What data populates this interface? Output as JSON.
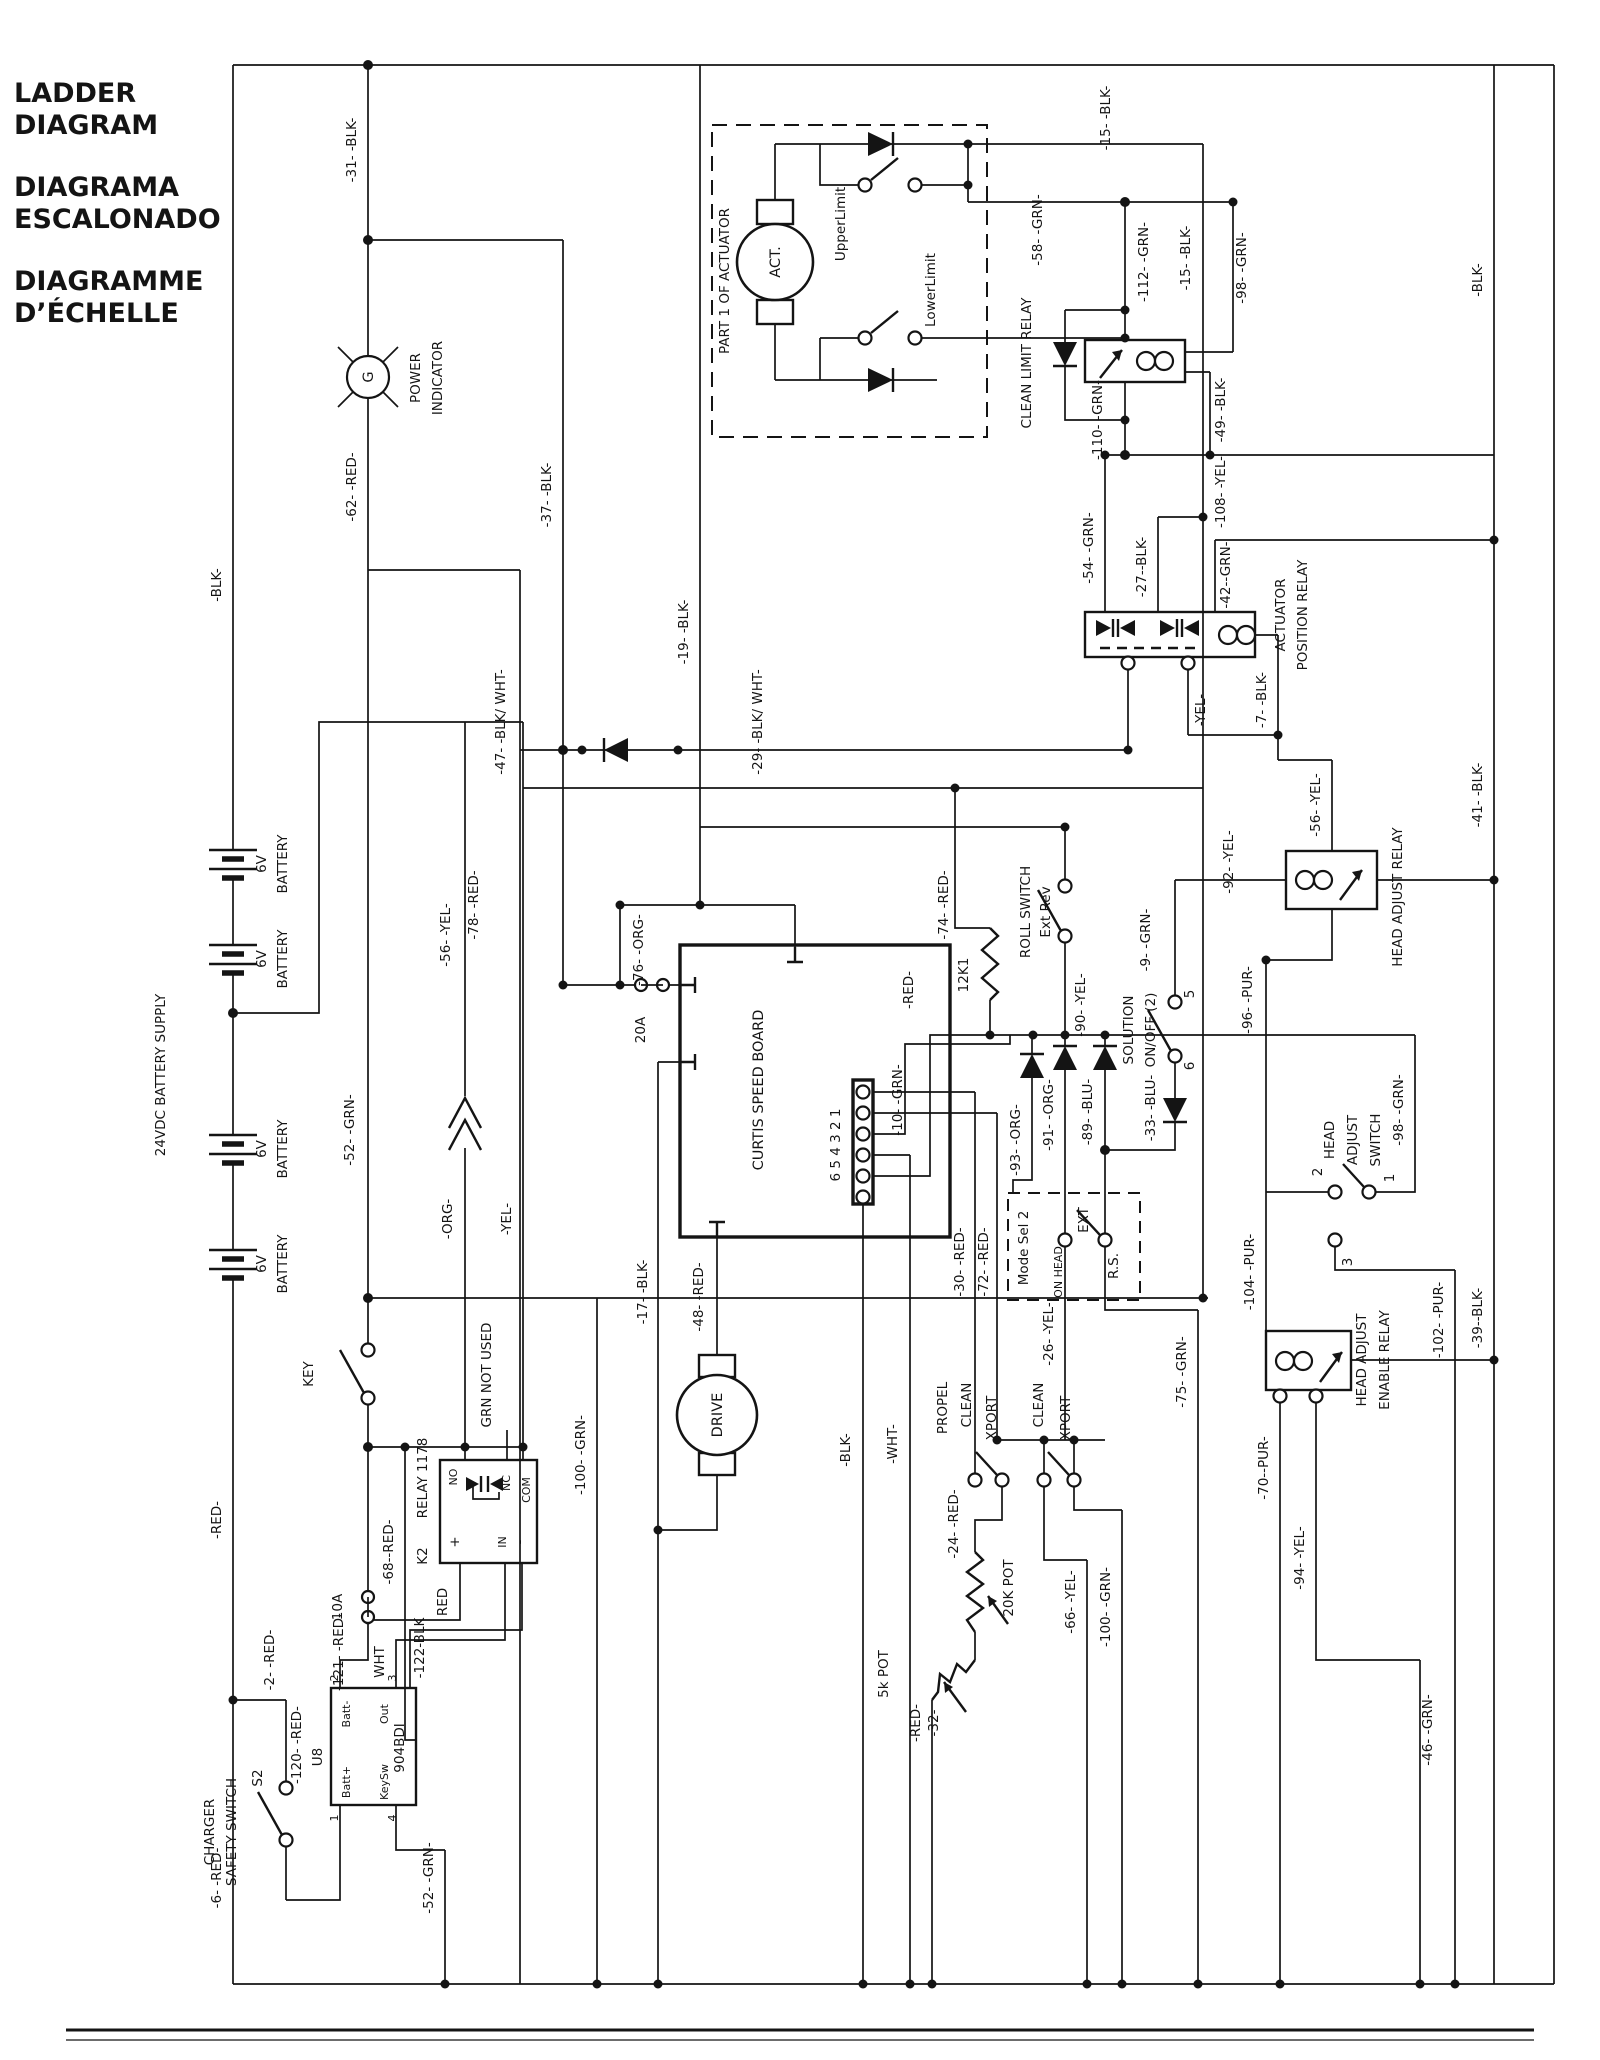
{
  "title": {
    "l1": "LADDER",
    "l2": "DIAGRAM",
    "l3": "DIAGRAMA",
    "l4": "ESCALONADO",
    "l5": "DIAGRAMME",
    "l6": "D’ÉCHELLE"
  },
  "power": {
    "battery_supply": "24VDC BATTERY SUPPLY",
    "battery_v": "6V",
    "battery": "BATTERY",
    "indicator": [
      "POWER",
      "INDICATOR"
    ],
    "lamp": "G",
    "key": "KEY",
    "fuse10": "10A",
    "fuse20": "20A"
  },
  "actuator": {
    "box": "PART 1 OF ACTUATOR",
    "motor": "ACT.",
    "upper": "UpperLimit",
    "lower": "LowerLimit"
  },
  "relays": {
    "clean_limit": "CLEAN LIMIT RELAY",
    "actuator_position": [
      "ACTUATOR",
      "POSITION RELAY"
    ],
    "head_adjust": "HEAD ADJUST RELAY",
    "head_adjust_enable": [
      "HEAD ADJUST",
      "ENABLE RELAY"
    ],
    "k2": {
      "id": "K2",
      "name": "RELAY 1178",
      "no": "NO",
      "nc": "NC",
      "com": "COM",
      "plus": "+",
      "in_": "IN",
      "minus": "-",
      "grn_not_used": "GRN NOT USED"
    }
  },
  "curtis": {
    "name": "CURTIS SPEED BOARD",
    "pins": "6 5 4 3 2 1",
    "r12k1": "12K1"
  },
  "drive": {
    "name": "DRIVE"
  },
  "switches": {
    "roll": [
      "ROLL SWITCH",
      "Ext Rev"
    ],
    "solution": [
      "SOLUTION",
      "ON/OFF (2)"
    ],
    "sol5": "5",
    "sol6": "6",
    "mode": {
      "name": "Mode Sel 2",
      "on_head": "ON HEAD",
      "ext": "EXT",
      "rs": "R.S."
    },
    "head_adjust": [
      "HEAD",
      "ADJUST",
      "SWITCH"
    ],
    "ha1": "1",
    "ha2": "2",
    "ha3": "3",
    "propel": "PROPEL",
    "clean": "CLEAN",
    "xport": "XPORT",
    "charger": [
      "CHARGER",
      "SAFETY SWITCH"
    ],
    "s2": "S2"
  },
  "pots": {
    "p20k": "20K POT",
    "p5k": "5k POT"
  },
  "u8": {
    "id": "U8",
    "chip": "904BDI",
    "p1": "1",
    "p2": "2",
    "p3": "3",
    "p4": "4",
    "battp": "Batt+",
    "battm": "Batt-",
    "out": "Out",
    "keysw": "KeySw"
  },
  "wires": {
    "w31": "-31- -BLK-",
    "wblk": "-BLK-",
    "w62": "-62- -RED-",
    "w37": "-37- -BLK-",
    "w19": "-19- -BLK-",
    "w47": "-47- -BLK/ WHT-",
    "w29": "-29- -BLK/ WHT-",
    "w15": "-15- -BLK-",
    "w58": "-58- -GRN-",
    "w112": "-112- -GRN-",
    "w110": "-110- -GRN-",
    "w98": "-98- -GRN-",
    "w49": "-49- -BLK-",
    "w108": "-108- -YEL-",
    "w54": "-54- -GRN-",
    "w27": "-27--BLK-",
    "w42": "-42--GRN-",
    "wyel": "-YEL-",
    "w7": "-7- -BLK-",
    "w56": "-56- -YEL-",
    "w41": "-41- -BLK-",
    "w39": "-39--BLK-",
    "w46": "-46- -GRN-",
    "w92": "-92- -YEL-",
    "w96": "-96- -PUR-",
    "w9": "-9- -GRN-",
    "w90": "-90- -YEL-",
    "w93": "-93- -ORG-",
    "w91": "-91- -ORG-",
    "w89": "-89- -BLU-",
    "w33": "-33- -BLU-",
    "w74": "-74- -RED-",
    "wred": "-RED-",
    "w10": "-10- -GRN-",
    "w76": "-76- -ORG-",
    "w78": "-78- -RED-",
    "worg": "-ORG-",
    "w52": "-52- -GRN-",
    "w100": "-100- -GRN-",
    "w68": "-68--RED-",
    "w121": "-121- -RED-",
    "w122": "-122-BLK",
    "wredp": "RED",
    "wwhtp": "WHT",
    "w120": "-120- -RED-",
    "w2": "-2- -RED-",
    "w6": "-6- -RED-",
    "w17": "-17- -BLK-",
    "w48": "-48- -RED-",
    "wwht": "-WHT-",
    "w30": "-30- -RED-",
    "w72": "-72- -RED-",
    "w24": "-24- -RED-",
    "w32": "-32-",
    "w66": "-66- -YEL-",
    "w26": "-26- -YEL-",
    "w75": "-75- -GRN-",
    "w70": "-70--PUR-",
    "w94": "-94- -YEL-",
    "w102": "-102- -PUR-",
    "w104": "-104- -PUR-"
  }
}
